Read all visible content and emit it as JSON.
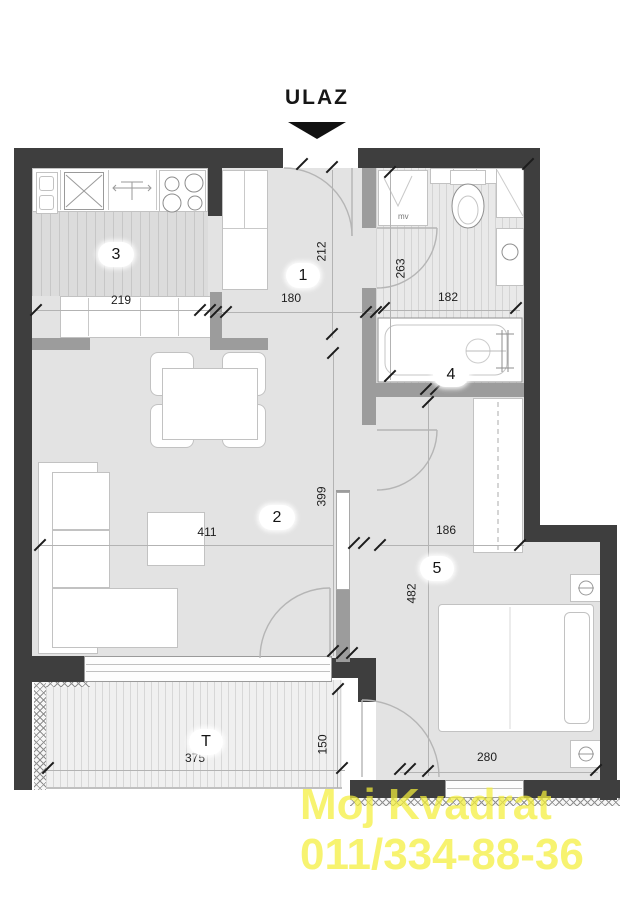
{
  "entrance": {
    "label": "ULAZ"
  },
  "rooms": {
    "hall": {
      "number": "1",
      "depth": "212",
      "width": "180"
    },
    "living": {
      "number": "2",
      "width": "411",
      "depth": "399"
    },
    "kitchen": {
      "number": "3",
      "width": "219"
    },
    "bathroom": {
      "number": "4",
      "depth": "263",
      "width": "182"
    },
    "bedroom": {
      "number": "5",
      "width_upper": "186",
      "depth": "482",
      "width": "280"
    },
    "terrace": {
      "label": "T",
      "width": "375",
      "depth": "150"
    }
  },
  "fixtures": {
    "washing_machine_label": "mv"
  },
  "watermark": {
    "line1": "Moj Kvadrat",
    "line2": "011/334-88-36",
    "color": "#f4ef3a"
  },
  "colors": {
    "exterior_wall": "#3e3e3e",
    "interior_wall": "#9c9c9c",
    "floor": "#e3e3e3"
  }
}
